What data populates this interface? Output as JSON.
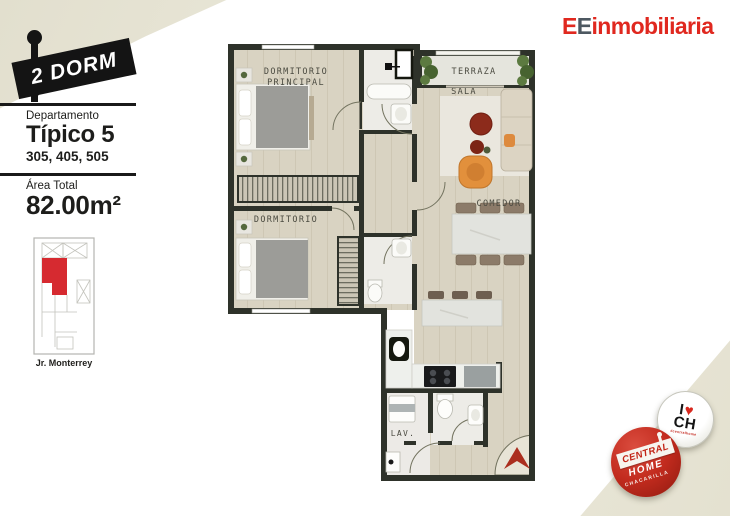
{
  "sign": {
    "label": "2 DORM"
  },
  "sidebar": {
    "dept_label": "Departamento",
    "dept_name": "Típico 5",
    "units": "305, 405, 505",
    "area_label": "Área Total",
    "area_value": "82.00m²",
    "street": "Jr. Monterrey"
  },
  "logo": {
    "e1": "E",
    "e2": "E",
    "rest": "inmobiliaria"
  },
  "floorplan": {
    "labels": {
      "master_1": "DORMITORIO",
      "master_2": "PRINCIPAL",
      "terrace": "TERRAZA",
      "living": "SALA",
      "dining": "COMEDOR",
      "bedroom": "DORMITORIO",
      "laundry": "LAV."
    }
  },
  "stamps": {
    "i_love": {
      "i": "I",
      "heart": "♥",
      "initials": "CH",
      "tagline": "#centralhome"
    },
    "central_home": {
      "top": "CENTRAL",
      "mid": "HOME",
      "bottom": "CHACARILLA"
    }
  },
  "colors": {
    "accent_red": "#e0281f",
    "logo_slate": "#4d5861",
    "wall": "#2e322a",
    "wood_floor": "#d9d3c2",
    "terrace_floor": "#e5e5dd",
    "paper": "#eae8da",
    "unit_highlight_red": "#d62a30",
    "entry_arrow_red": "#ab2e1e",
    "stamp_red": "#c22b1e"
  }
}
